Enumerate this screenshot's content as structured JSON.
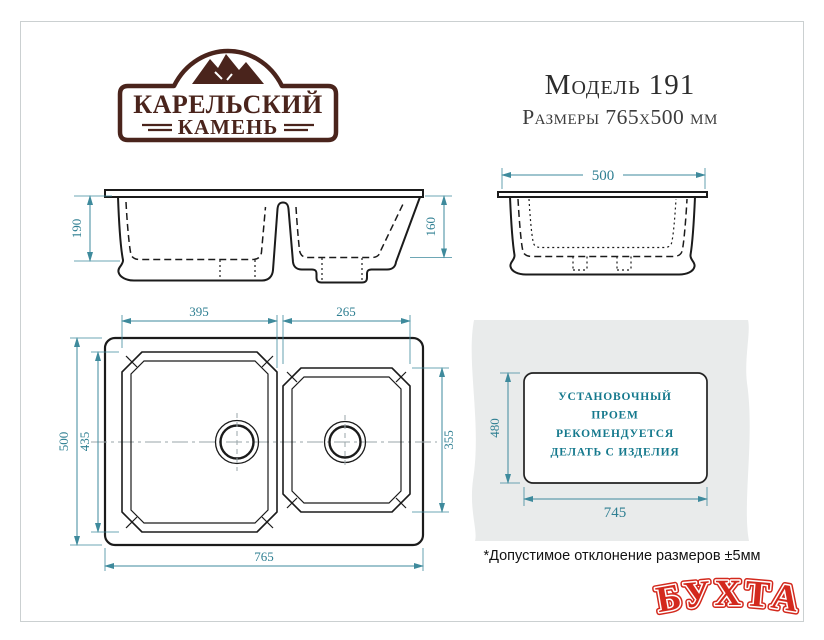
{
  "brand": {
    "logo_top": "КАРЕЛЬСКИЙ",
    "logo_bottom": "КАМЕНЬ"
  },
  "header": {
    "model": "Модель 191",
    "dimensions": "Размеры 765х500 мм"
  },
  "views": {
    "front": {
      "left_bowl_depth": "190",
      "right_bowl_depth": "160"
    },
    "side": {
      "overall_depth": "500"
    },
    "plan": {
      "left_bowl_width": "395",
      "right_bowl_width": "265",
      "overall_depth": "500",
      "left_bowl_length": "435",
      "right_bowl_length": "355",
      "overall_width": "765"
    },
    "cutout": {
      "height": "480",
      "width": "745",
      "note_line1": "УСТАНОВОЧНЫЙ",
      "note_line2": "ПРОЕМ",
      "note_line3": "РЕКОМЕНДУЕТСЯ",
      "note_line4": "ДЕЛАТЬ С ИЗДЕЛИЯ"
    }
  },
  "footnote": "*Допустимое отклонение размеров ±5мм",
  "watermark": "БУХТА",
  "colors": {
    "dimension_teal": "#3e8a9c",
    "line_black": "#1b1b1b",
    "logo_brown": "#4a241c",
    "install_text_teal": "#15798d",
    "watermark_red": "#d3291d",
    "countertop_gray": "#e9ebeb"
  }
}
